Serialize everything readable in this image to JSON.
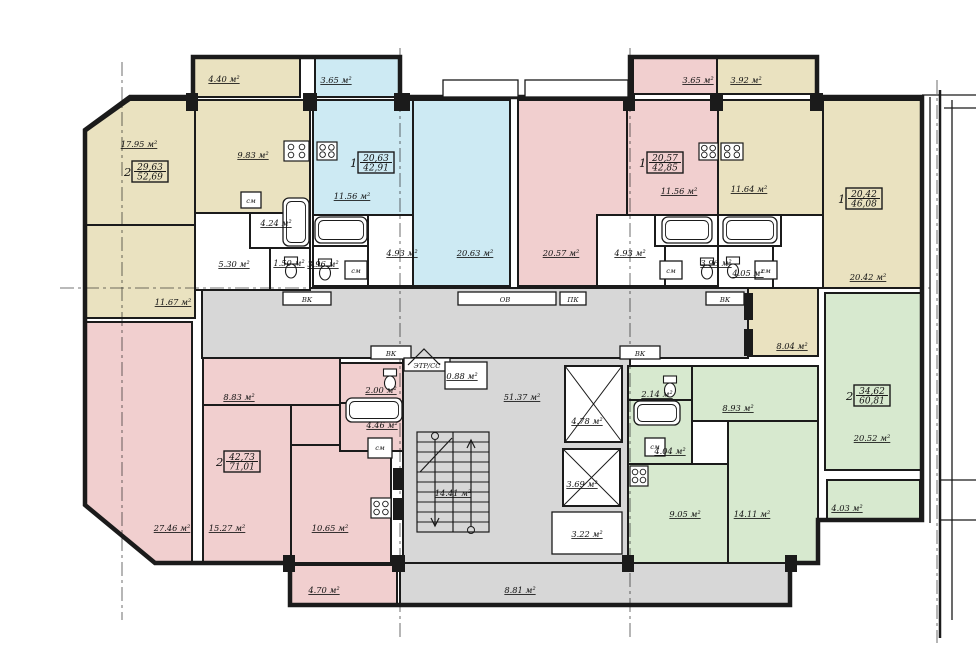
{
  "title": "apartment-building-floor-plan",
  "colors": {
    "bg": "#ffffff",
    "line": "#1b1b1b",
    "beige": "#eae2c0",
    "blue": "#cdeaf3",
    "pink": "#f1cfcf",
    "green": "#d7e9cf",
    "gray": "#d7d7d7",
    "white": "#ffffff"
  },
  "plan": {
    "outline": "130,97 193,97 193,57 400,57 400,97 630,97 630,57 817,57 817,97 922,97 922,520 818,520 818,563 790,563 790,605 290,605 290,563 155,563 85,505 85,130",
    "rooms": [
      {
        "n": "corridor-upper",
        "f": "gray",
        "r": [
          202,
          288,
          546,
          70
        ]
      },
      {
        "n": "stair-core",
        "f": "gray",
        "r": [
          403,
          358,
          227,
          205
        ]
      },
      {
        "n": "loggia-8-81",
        "f": "gray",
        "r": [
          400,
          563,
          390,
          42
        ]
      },
      {
        "n": "apt1-balcony-4-40",
        "f": "beige",
        "r": [
          193,
          58,
          107,
          39
        ]
      },
      {
        "n": "apt1-living-17-95",
        "f": "beige",
        "p": "130,100 195,100 195,225 85,225 85,132"
      },
      {
        "n": "apt1-kitchen-9-83",
        "f": "beige",
        "r": [
          195,
          100,
          115,
          113
        ]
      },
      {
        "n": "apt1-room-11-67",
        "f": "beige",
        "r": [
          85,
          225,
          110,
          93
        ]
      },
      {
        "n": "apt1-hall-5-30",
        "f": "white",
        "r": [
          195,
          213,
          115,
          77
        ]
      },
      {
        "n": "apt1-bath-4-24",
        "f": "white",
        "r": [
          250,
          213,
          60,
          35
        ]
      },
      {
        "n": "apt1-wc-1-50",
        "f": "white",
        "r": [
          270,
          248,
          40,
          42
        ]
      },
      {
        "n": "apt2-balcony-3-65",
        "f": "blue",
        "r": [
          315,
          58,
          85,
          39
        ]
      },
      {
        "n": "apt2-kitchen-11-56",
        "f": "blue",
        "r": [
          313,
          100,
          100,
          115
        ]
      },
      {
        "n": "apt2-room-20-63",
        "f": "blue",
        "r": [
          413,
          100,
          97,
          186
        ]
      },
      {
        "n": "apt2-hall-4-93",
        "f": "white",
        "r": [
          368,
          215,
          45,
          71
        ]
      },
      {
        "n": "apt2-bath",
        "f": "white",
        "r": [
          313,
          215,
          55,
          31
        ]
      },
      {
        "n": "apt2-wc-3-96",
        "f": "white",
        "r": [
          313,
          246,
          55,
          40
        ]
      },
      {
        "n": "apt3-room-20-57",
        "f": "pink",
        "r": [
          518,
          100,
          109,
          186
        ]
      },
      {
        "n": "apt3-kitchen-11-56",
        "f": "pink",
        "r": [
          627,
          100,
          91,
          115
        ]
      },
      {
        "n": "apt3-balcony-3-65",
        "f": "pink",
        "r": [
          633,
          58,
          84,
          36
        ]
      },
      {
        "n": "apt3-hall-4-93",
        "f": "white",
        "r": [
          597,
          215,
          121,
          71
        ]
      },
      {
        "n": "apt3-bath",
        "f": "white",
        "r": [
          655,
          215,
          63,
          31
        ]
      },
      {
        "n": "apt3-wc-3-96",
        "f": "white",
        "r": [
          665,
          246,
          53,
          40
        ]
      },
      {
        "n": "apt4-balcony-3-92",
        "f": "beige",
        "r": [
          717,
          58,
          100,
          36
        ]
      },
      {
        "n": "apt4-kitchen-11-64",
        "f": "beige",
        "r": [
          718,
          100,
          105,
          115
        ]
      },
      {
        "n": "apt4-room-20-42",
        "f": "beige",
        "r": [
          823,
          100,
          99,
          188
        ]
      },
      {
        "n": "apt4-hall",
        "f": "white",
        "r": [
          718,
          215,
          105,
          73
        ]
      },
      {
        "n": "apt4-bath",
        "f": "white",
        "r": [
          718,
          215,
          63,
          31
        ]
      },
      {
        "n": "apt4-wc-4-05",
        "f": "white",
        "r": [
          718,
          246,
          55,
          42
        ]
      },
      {
        "n": "apt4-room-8-04",
        "f": "beige",
        "r": [
          748,
          288,
          70,
          68
        ]
      },
      {
        "n": "apt5-room-27-46",
        "f": "pink",
        "p": "85,322 192,322 192,563 155,563 85,505"
      },
      {
        "n": "apt5-hall-8-83",
        "f": "pink",
        "r": [
          203,
          358,
          137,
          47
        ]
      },
      {
        "n": "apt5-hall-conn",
        "f": "pink",
        "r": [
          291,
          405,
          49,
          40
        ]
      },
      {
        "n": "apt5-room-15-27",
        "f": "pink",
        "r": [
          203,
          405,
          88,
          158
        ]
      },
      {
        "n": "apt5-kitchen-10-65",
        "f": "pink",
        "r": [
          291,
          445,
          100,
          118
        ]
      },
      {
        "n": "apt5-wc-2-00",
        "f": "pink",
        "r": [
          340,
          363,
          63,
          40
        ]
      },
      {
        "n": "apt5-bath-4-46",
        "f": "pink",
        "r": [
          340,
          403,
          63,
          48
        ]
      },
      {
        "n": "apt5-balcony-4-70",
        "f": "pink",
        "r": [
          290,
          565,
          107,
          40
        ]
      },
      {
        "n": "apt6-wc-2-14",
        "f": "green",
        "r": [
          628,
          366,
          64,
          34
        ]
      },
      {
        "n": "apt6-bath-4-04",
        "f": "green",
        "r": [
          628,
          400,
          64,
          64
        ]
      },
      {
        "n": "apt6-hall-8-93",
        "f": "green",
        "r": [
          692,
          366,
          126,
          55
        ]
      },
      {
        "n": "apt6-room-9-05",
        "f": "green",
        "r": [
          628,
          464,
          100,
          99
        ]
      },
      {
        "n": "apt6-room-14-11",
        "f": "green",
        "r": [
          728,
          421,
          90,
          142
        ]
      },
      {
        "n": "apt6-room-20-52",
        "f": "green",
        "r": [
          825,
          293,
          97,
          177
        ]
      },
      {
        "n": "apt6-balcony-4-03",
        "f": "green",
        "r": [
          827,
          480,
          93,
          40
        ]
      }
    ],
    "boxes": [
      {
        "n": "tag-box-vk-1",
        "r": [
          283,
          292,
          48,
          13
        ]
      },
      {
        "n": "tag-box-ov",
        "r": [
          458,
          292,
          98,
          13
        ]
      },
      {
        "n": "tag-box-pk",
        "r": [
          560,
          292,
          26,
          13
        ]
      },
      {
        "n": "tag-box-vk-2",
        "r": [
          706,
          292,
          38,
          13
        ]
      },
      {
        "n": "tag-box-vk-3",
        "r": [
          371,
          346,
          40,
          13
        ]
      },
      {
        "n": "tag-box-vk-4",
        "r": [
          620,
          346,
          40,
          13
        ]
      },
      {
        "n": "tag-box-etr",
        "r": [
          404,
          358,
          46,
          13
        ]
      },
      {
        "n": "room-0-88",
        "r": [
          445,
          362,
          42,
          27
        ]
      },
      {
        "n": "entry-porch-1",
        "r": [
          443,
          80,
          75,
          17
        ]
      },
      {
        "n": "entry-porch-2",
        "r": [
          525,
          80,
          103,
          17
        ]
      },
      {
        "n": "elevator-room-3-22",
        "r": [
          552,
          512,
          70,
          42
        ]
      },
      {
        "n": "sm-box-1",
        "r": [
          241,
          192,
          20,
          16
        ]
      },
      {
        "n": "sm-box-2",
        "r": [
          345,
          261,
          22,
          18
        ]
      },
      {
        "n": "sm-box-3",
        "r": [
          660,
          261,
          22,
          18
        ]
      },
      {
        "n": "sm-box-4",
        "r": [
          755,
          261,
          22,
          18
        ]
      },
      {
        "n": "sm-box-5",
        "r": [
          368,
          438,
          24,
          20
        ]
      },
      {
        "n": "sm-box-6",
        "r": [
          645,
          438,
          20,
          18
        ]
      }
    ],
    "shafts": [
      {
        "n": "elevator-shaft-1",
        "r": [
          565,
          366,
          57,
          76
        ]
      },
      {
        "n": "elevator-shaft-2",
        "r": [
          563,
          449,
          57,
          57
        ]
      }
    ],
    "piers": [
      [
        186,
        93,
        12,
        18
      ],
      [
        303,
        93,
        14,
        18
      ],
      [
        394,
        93,
        16,
        18
      ],
      [
        623,
        93,
        12,
        18
      ],
      [
        710,
        93,
        13,
        18
      ],
      [
        810,
        93,
        13,
        18
      ],
      [
        283,
        555,
        12,
        17
      ],
      [
        392,
        555,
        13,
        17
      ],
      [
        622,
        555,
        12,
        17
      ],
      [
        785,
        555,
        12,
        17
      ],
      [
        744,
        293,
        9,
        27
      ],
      [
        744,
        329,
        9,
        27
      ],
      [
        393,
        468,
        9,
        22
      ],
      [
        393,
        498,
        9,
        22
      ]
    ],
    "tubs": [
      [
        283,
        198,
        26,
        48
      ],
      [
        315,
        217,
        52,
        26
      ],
      [
        662,
        217,
        50,
        26
      ],
      [
        723,
        217,
        54,
        26
      ],
      [
        346,
        398,
        56,
        24
      ],
      [
        634,
        401,
        46,
        24
      ]
    ],
    "toilets": [
      [
        291,
        271
      ],
      [
        325,
        273
      ],
      [
        707,
        272
      ],
      [
        733,
        271
      ],
      [
        390,
        383
      ],
      [
        670,
        390
      ]
    ],
    "stoves": [
      [
        284,
        141,
        25,
        20
      ],
      [
        317,
        142,
        20,
        18
      ],
      [
        699,
        143,
        19,
        17
      ],
      [
        721,
        143,
        22,
        17
      ],
      [
        371,
        498,
        20,
        20
      ],
      [
        630,
        466,
        18,
        20
      ]
    ],
    "stairs": {
      "x": 417,
      "y": 432,
      "w": 72,
      "h": 100,
      "rows": 10
    },
    "decor_lines": [
      {
        "n": "entry-peak-icon",
        "pts": "408,365 424,349 440,365"
      },
      {
        "n": "stair-diagonal",
        "pts": "420,472 452,438"
      },
      {
        "n": "stair-arrow-down",
        "pts": "435,440 435,526"
      },
      {
        "n": "stair-arrow-down-head",
        "pts": "431,518 435,526 439,518"
      },
      {
        "n": "stair-arrow-up",
        "pts": "471,526 471,440"
      },
      {
        "n": "stair-arrow-up-head",
        "pts": "467,448 471,440 475,448"
      }
    ],
    "circles": [
      [
        435,
        436
      ],
      [
        471,
        530
      ]
    ],
    "axes": [
      [
        122,
        62,
        122,
        620
      ],
      [
        400,
        48,
        400,
        640
      ],
      [
        630,
        48,
        630,
        640
      ],
      [
        937,
        80,
        937,
        643
      ],
      [
        60,
        288,
        930,
        288
      ]
    ],
    "adjacent": [
      [
        930,
        97,
        930,
        523
      ],
      [
        940,
        90,
        940,
        638
      ],
      [
        952,
        100,
        952,
        620
      ],
      [
        922,
        95,
        976,
        95
      ],
      [
        944,
        108,
        976,
        108
      ],
      [
        940,
        480,
        976,
        480
      ],
      [
        940,
        520,
        976,
        520
      ]
    ],
    "labels": [
      {
        "t": "4.40 м²",
        "x": 224,
        "y": 82
      },
      {
        "t": "17.95 м²",
        "x": 139,
        "y": 147
      },
      {
        "t": "9.83 м²",
        "x": 253,
        "y": 158
      },
      {
        "t": "4.24 м²",
        "x": 276,
        "y": 226
      },
      {
        "t": "5.30 м²",
        "x": 234,
        "y": 267
      },
      {
        "t": "1.50 м²",
        "x": 289,
        "y": 266
      },
      {
        "t": "11.67 м²",
        "x": 173,
        "y": 305
      },
      {
        "t": "3.65 м²",
        "x": 336,
        "y": 83
      },
      {
        "t": "11.56 м²",
        "x": 352,
        "y": 199
      },
      {
        "t": "20.63 м²",
        "x": 475,
        "y": 256
      },
      {
        "t": "4.93 м²",
        "x": 402,
        "y": 256
      },
      {
        "t": "3.96 м²",
        "x": 323,
        "y": 267
      },
      {
        "t": "3.65 м²",
        "x": 698,
        "y": 83
      },
      {
        "t": "20.57 м²",
        "x": 561,
        "y": 256
      },
      {
        "t": "4.93 м²",
        "x": 630,
        "y": 256
      },
      {
        "t": "11.56 м²",
        "x": 679,
        "y": 194
      },
      {
        "t": "3.96 м²",
        "x": 716,
        "y": 266
      },
      {
        "t": "3.92 м²",
        "x": 746,
        "y": 83
      },
      {
        "t": "11.64 м²",
        "x": 749,
        "y": 192
      },
      {
        "t": "4.05 м²",
        "x": 748,
        "y": 276
      },
      {
        "t": "20.42 м²",
        "x": 868,
        "y": 280
      },
      {
        "t": "8.04 м²",
        "x": 792,
        "y": 349
      },
      {
        "t": "51.37 м²",
        "x": 522,
        "y": 400
      },
      {
        "t": "4.78 м²",
        "x": 587,
        "y": 424
      },
      {
        "t": "3.69 м²",
        "x": 582,
        "y": 487
      },
      {
        "t": "3.22 м²",
        "x": 587,
        "y": 537
      },
      {
        "t": "14.41 м²",
        "x": 453,
        "y": 496
      },
      {
        "t": "0.88 м²",
        "x": 462,
        "y": 379
      },
      {
        "t": "8.81 м²",
        "x": 520,
        "y": 593
      },
      {
        "t": "8.83 м²",
        "x": 239,
        "y": 400
      },
      {
        "t": "2.00 м²",
        "x": 381,
        "y": 393
      },
      {
        "t": "4.46 м²",
        "x": 382,
        "y": 428
      },
      {
        "t": "27.46 м²",
        "x": 172,
        "y": 531
      },
      {
        "t": "15.27 м²",
        "x": 227,
        "y": 531
      },
      {
        "t": "10.65 м²",
        "x": 330,
        "y": 531
      },
      {
        "t": "4.70 м²",
        "x": 324,
        "y": 593
      },
      {
        "t": "2.14 м²",
        "x": 657,
        "y": 397
      },
      {
        "t": "4.04 м²",
        "x": 670,
        "y": 454
      },
      {
        "t": "8.93 м²",
        "x": 738,
        "y": 411
      },
      {
        "t": "9.05 м²",
        "x": 685,
        "y": 517
      },
      {
        "t": "14.11 м²",
        "x": 752,
        "y": 517
      },
      {
        "t": "20.52 м²",
        "x": 872,
        "y": 441
      },
      {
        "t": "4.03 м²",
        "x": 847,
        "y": 511
      }
    ],
    "tags": [
      {
        "t": "ВК",
        "x": 307,
        "y": 302
      },
      {
        "t": "ОВ",
        "x": 505,
        "y": 302
      },
      {
        "t": "ПК",
        "x": 573,
        "y": 302
      },
      {
        "t": "ВК",
        "x": 725,
        "y": 302
      },
      {
        "t": "ВК",
        "x": 391,
        "y": 356
      },
      {
        "t": "ВК",
        "x": 640,
        "y": 356
      },
      {
        "t": "ЭТР/СС",
        "x": 427,
        "y": 368
      },
      {
        "t": "см",
        "x": 251,
        "y": 203
      },
      {
        "t": "см",
        "x": 356,
        "y": 273
      },
      {
        "t": "см",
        "x": 671,
        "y": 273
      },
      {
        "t": "см",
        "x": 766,
        "y": 273
      },
      {
        "t": "см",
        "x": 380,
        "y": 450
      },
      {
        "t": "см",
        "x": 655,
        "y": 449
      }
    ],
    "badges": [
      {
        "d": "2",
        "a": "29,63",
        "b": "52,69",
        "x": 120,
        "y": 160
      },
      {
        "d": "1",
        "a": "20,63",
        "b": "42,91",
        "x": 346,
        "y": 151
      },
      {
        "d": "1",
        "a": "20,57",
        "b": "42,85",
        "x": 635,
        "y": 151
      },
      {
        "d": "1",
        "a": "20,42",
        "b": "46,08",
        "x": 834,
        "y": 187
      },
      {
        "d": "2",
        "a": "42,73",
        "b": "71,01",
        "x": 212,
        "y": 450
      },
      {
        "d": "2",
        "a": "34,62",
        "b": "60,81",
        "x": 842,
        "y": 384
      }
    ]
  }
}
